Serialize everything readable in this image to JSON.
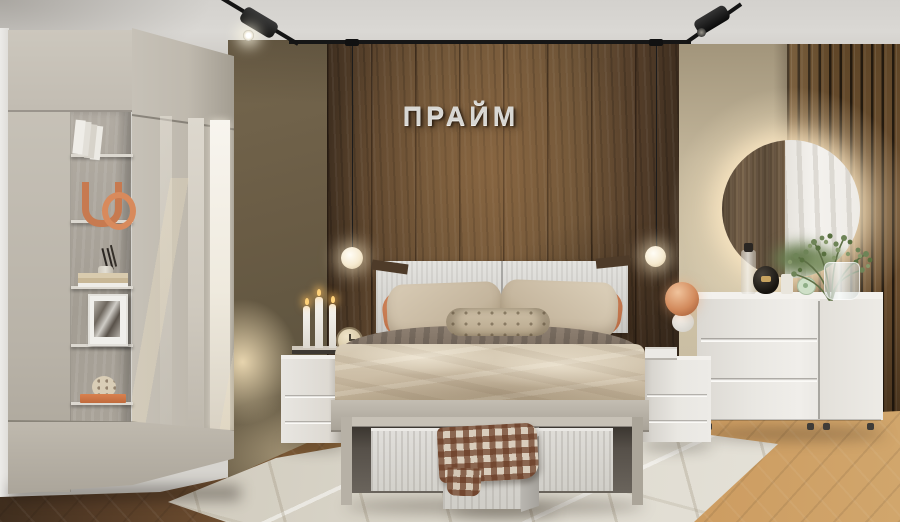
{
  "scene": {
    "type": "photorealistic bedroom interior render",
    "elements": [
      "track lighting",
      "pendant globe lamps",
      "wood panel accent wall",
      "slat wall",
      "round backlit mirror",
      "wardrobe with open shelving",
      "double bed",
      "bedside tables",
      "chest of drawers",
      "storage bench with fabric bins",
      "area rug",
      "plant in glass vase"
    ]
  },
  "sign": {
    "text": "ПРАЙМ"
  },
  "palette": {
    "wood_wall": "#6b5236",
    "wood_dark": "#3f2f1f",
    "olive_wall": "#675a44",
    "beige_wall": "#c9bda2",
    "furniture_greige": "#c2bcb2",
    "furniture_white": "#e7e5e0",
    "bedding": "#d2c5af",
    "accent_orange": "#c97f55",
    "floor_light": "#c99a62",
    "floor_dark": "#4a3524",
    "rug": "#d8d4c9",
    "warm_glow": "#ffe9c4"
  },
  "counts": {
    "pendant_lamps": 2,
    "ceiling_spotlights": 2,
    "dresser_drawers": 3,
    "candles": 3,
    "storage_bins": 3,
    "headboard_panels": 2
  }
}
